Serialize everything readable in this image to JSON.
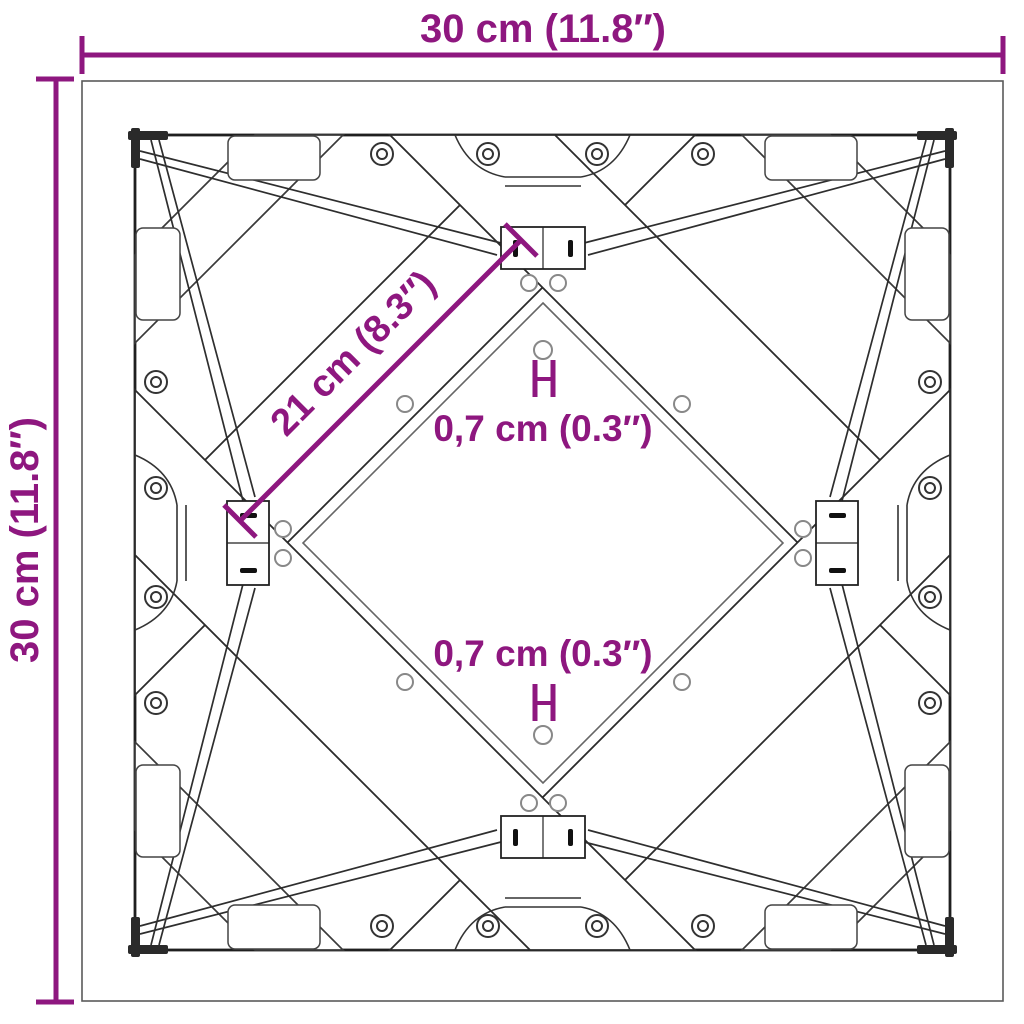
{
  "diagram": {
    "type": "technical-dimension-drawing",
    "subject": "square table top cross-frame, top view",
    "units": "metric with imperial in parentheses"
  },
  "colors": {
    "dimension": "#8E177F",
    "outline_dark": "#1f1f1f",
    "outline_mid": "#4d4d4d",
    "outline_light": "#8c8c8c",
    "background": "#ffffff"
  },
  "annotations": {
    "width": {
      "label": "30 cm (11.8″)",
      "position": "top"
    },
    "height": {
      "label": "30 cm (11.8″)",
      "position": "left",
      "rotated": "90deg"
    },
    "bar_length": {
      "label": "21 cm (8.3″)",
      "position": "diagonal",
      "rotated": "45deg"
    },
    "hole_diameter_top": {
      "label": "0,7 cm (0.3″)"
    },
    "hole_diameter_bottom": {
      "label": "0,7 cm (0.3″)"
    }
  }
}
